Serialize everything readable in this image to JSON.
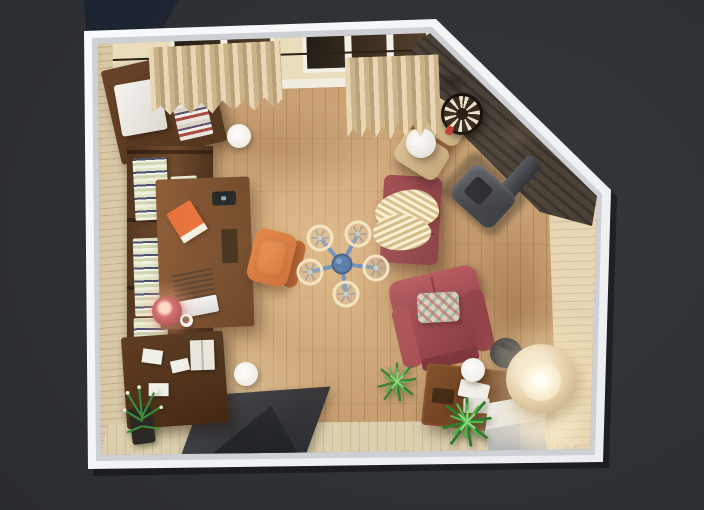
{
  "scene": {
    "type": "3d-floorplan-render",
    "view": "top-down interior render of a living room with home office, pentagon-shaped room with clipped top-right corner",
    "colors": {
      "background": "#2b2e32",
      "wall_frame": "#f6f7f8",
      "floor_wood": "#c39a6c",
      "floor_highlight": "#e8d2a6",
      "left_wall_brick": "#d8c8a6",
      "stone_accent_wall": "#4a4138",
      "window_glass": "#2a211a",
      "curtain_beige": "#d9c4a0",
      "dark_walnut": "#54351d",
      "desk_wood": "#7a4c29",
      "desk_chair_orange": "#d86c31",
      "daybed_maroon": "#8e3a44",
      "armchair_red": "#9c4148",
      "pillow_teal": "#6eaaa0",
      "blanket_cream": "#ead9ab",
      "fan_blue": "#3e6cab",
      "fan_ring_cream": "#f2e5c4",
      "stove_grey": "#44484f",
      "rug_charcoal": "#33363b",
      "plant_green": "#46a33f",
      "lamp_shade": "#e3cda6",
      "lamp_glow": "#fff3d4",
      "pouf_grey": "#c6cad1",
      "dartboard_cream": "#ece2ca"
    },
    "items": [
      {
        "id": "room",
        "label": "Room with white wall frame and angled corner"
      },
      {
        "id": "floor",
        "label": "Wooden plank floor"
      },
      {
        "id": "left-wall",
        "label": "Beige brick wall"
      },
      {
        "id": "window",
        "label": "Window with dark panes and white frame"
      },
      {
        "id": "curtain-left",
        "label": "Beige curtain"
      },
      {
        "id": "curtain-right",
        "label": "Beige curtain"
      },
      {
        "id": "stone-wall",
        "label": "Dark stone accent wall"
      },
      {
        "id": "dartboard",
        "label": "Dartboard"
      },
      {
        "id": "wood-stove",
        "label": "Grey wood stove with chimney pipe"
      },
      {
        "id": "lounge-chair",
        "label": "Lounge chair with beige cushions"
      },
      {
        "id": "white-side-table",
        "label": "Round white side table"
      },
      {
        "id": "top-left-cabinet",
        "label": "Dark wood cabinet"
      },
      {
        "id": "mini-fridge",
        "label": "White mini fridge"
      },
      {
        "id": "bookshelf",
        "label": "Wall bookshelf with books"
      },
      {
        "id": "desk",
        "label": "Wooden writing desk"
      },
      {
        "id": "laptop",
        "label": "Open laptop"
      },
      {
        "id": "orange-book",
        "label": "Orange book"
      },
      {
        "id": "smartphone",
        "label": "Smartphone"
      },
      {
        "id": "desk-lamp",
        "label": "Glowing red desk lamp"
      },
      {
        "id": "cup",
        "label": "White cup"
      },
      {
        "id": "desk-chair",
        "label": "Orange desk chair"
      },
      {
        "id": "sideboard",
        "label": "Dark wood sideboard with papers"
      },
      {
        "id": "flower-plant",
        "label": "Potted plant with white flowers"
      },
      {
        "id": "rug",
        "label": "Dark grey rug"
      },
      {
        "id": "ceiling-fan",
        "label": "Blue five-blade ceiling fan"
      },
      {
        "id": "daybed",
        "label": "Maroon upholstered bench"
      },
      {
        "id": "blanket",
        "label": "Cream knitted blanket"
      },
      {
        "id": "armchair",
        "label": "Red armchair"
      },
      {
        "id": "pillow",
        "label": "Patterned throw pillow"
      },
      {
        "id": "coffee-table",
        "label": "Wooden coffee table with books"
      },
      {
        "id": "pouf",
        "label": "Light grey cube pouf"
      },
      {
        "id": "floor-lamp",
        "label": "Beige floor lamp, lit"
      },
      {
        "id": "black-side-table",
        "label": "Black round side table"
      },
      {
        "id": "plant-1",
        "label": "Green spiky plant"
      },
      {
        "id": "plant-2",
        "label": "Green spiky plant"
      },
      {
        "id": "floor-light-1",
        "label": "Round white floor light"
      },
      {
        "id": "floor-light-2",
        "label": "Round white floor light"
      },
      {
        "id": "floor-light-3",
        "label": "Round white floor light"
      },
      {
        "id": "bottom-wall",
        "label": "Light beige wall"
      },
      {
        "id": "right-wall",
        "label": "Beige brick wall with lamp glow"
      }
    ]
  }
}
